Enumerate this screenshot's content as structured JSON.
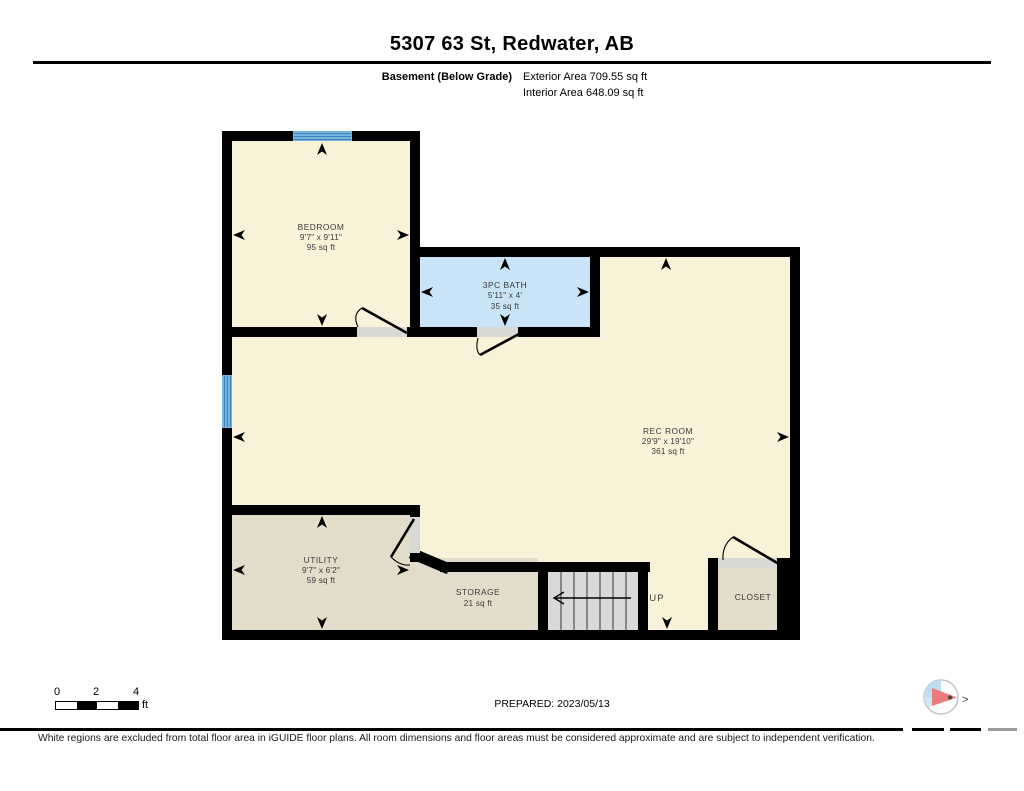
{
  "header": {
    "title": "5307 63 St, Redwater, AB",
    "floor_label": "Basement (Below Grade)",
    "exterior_area": "Exterior Area 709.55 sq ft",
    "interior_area": "Interior Area 648.09 sq ft"
  },
  "rooms": {
    "bedroom": {
      "name": "BEDROOM",
      "dims": "9'7\" x 9'11\"",
      "area": "95 sq ft"
    },
    "bath": {
      "name": "3PC BATH",
      "dims": "5'11\" x 4'",
      "area": "35 sq ft"
    },
    "rec_room": {
      "name": "REC ROOM",
      "dims": "29'9\" x 19'10\"",
      "area": "361 sq ft"
    },
    "utility": {
      "name": "UTILITY",
      "dims": "9'7\" x 6'2\"",
      "area": "59 sq ft"
    },
    "storage": {
      "name": "STORAGE",
      "area": "21 sq ft"
    },
    "closet": {
      "name": "CLOSET"
    },
    "stairs": {
      "direction_label": "UP"
    }
  },
  "scale_bar": {
    "labels": [
      "0",
      "2",
      "4"
    ],
    "unit": "ft"
  },
  "compass": {
    "north_marker": ">"
  },
  "footer": {
    "prepared": "PREPARED: 2023/05/13",
    "disclaimer": "White regions are excluded from total floor area in iGUIDE floor plans. All room dimensions and floor areas must be considered approximate and are subject to independent verification."
  },
  "colors": {
    "wall_black": "#000000",
    "floor_cream": "#FAF1D9",
    "floor_tan": "#E3DCCB",
    "bath_blue": "#C9E4F7",
    "stairs_gray": "#D9D9D9",
    "door_gray": "#D8D8D4",
    "window_blue": "#74B6DF",
    "window_stripe": "#3D85B4",
    "compass_blue": "#BCDCF0",
    "compass_blue_light": "#D2E7F6",
    "compass_red": "#EE7B7B"
  }
}
